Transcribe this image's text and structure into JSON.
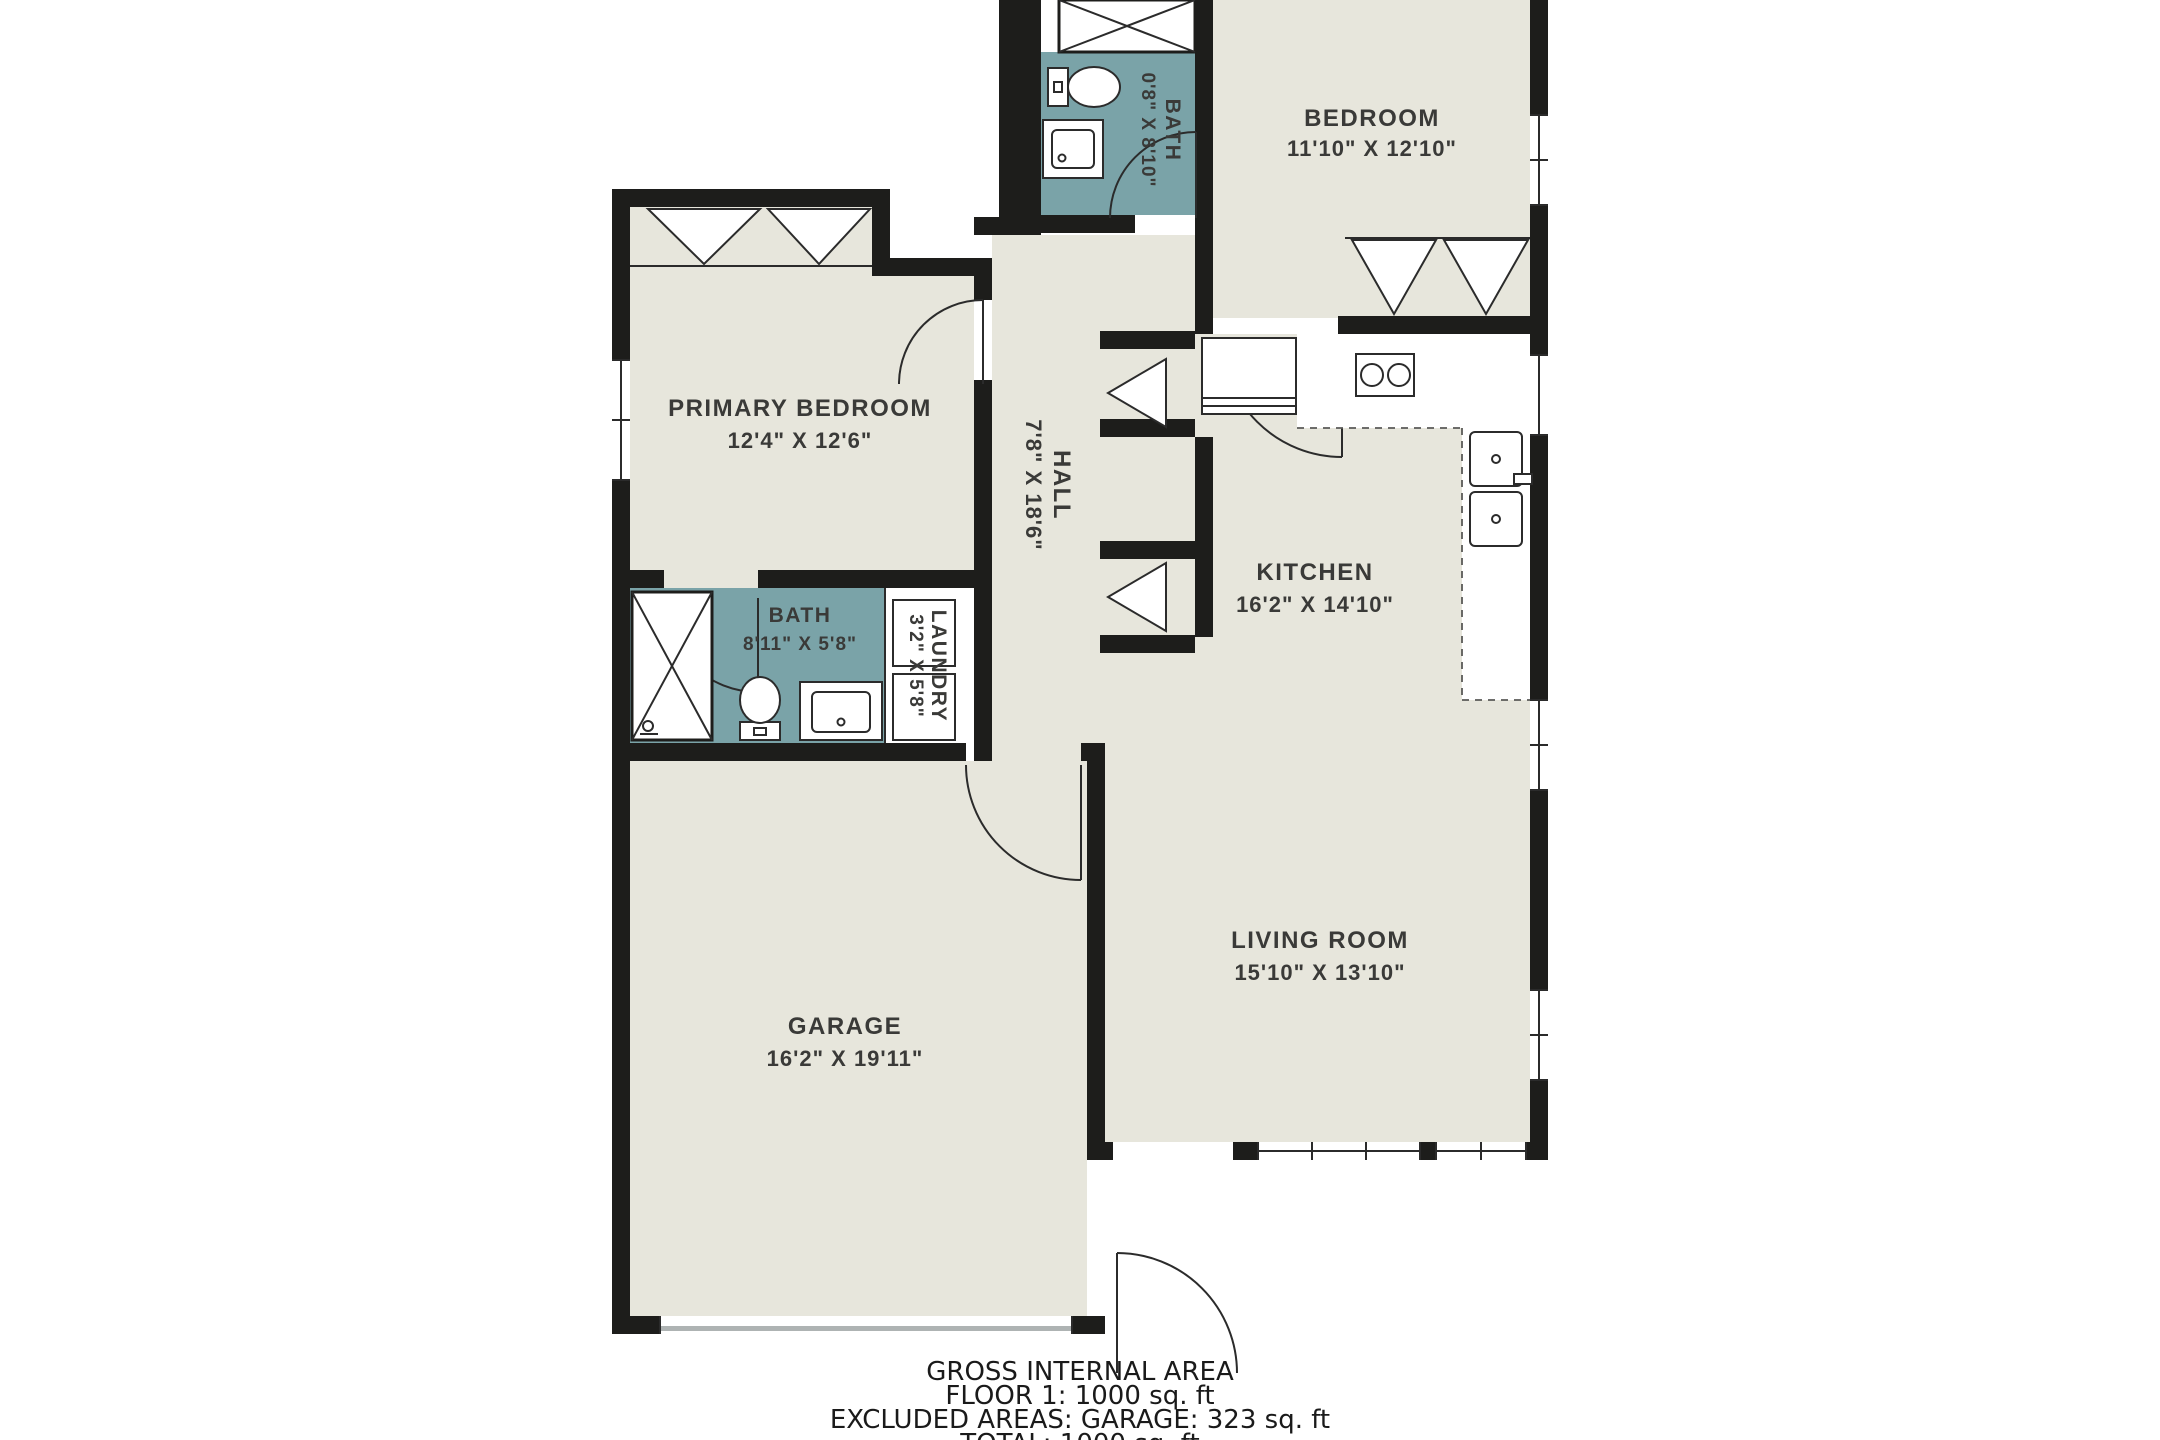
{
  "plan": {
    "type": "floor-plan",
    "rooms": {
      "primary_bedroom": {
        "name": "PRIMARY BEDROOM",
        "dims": "12'4\" X 12'6\""
      },
      "bedroom": {
        "name": "BEDROOM",
        "dims": "11'10\" X 12'10\""
      },
      "bath_upper": {
        "name": "BATH",
        "dims": "0'8\" X 8'10\""
      },
      "bath_main": {
        "name": "BATH",
        "dims": "8'11\" X 5'8\""
      },
      "laundry": {
        "name": "LAUNDRY",
        "dims": "3'2\" X 5'8\""
      },
      "hall": {
        "name": "HALL",
        "dims": "7'8\" X 18'6\""
      },
      "kitchen": {
        "name": "KITCHEN",
        "dims": "16'2\" X 14'10\""
      },
      "living_room": {
        "name": "LIVING ROOM",
        "dims": "15'10\" X 13'10\""
      },
      "garage": {
        "name": "GARAGE",
        "dims": "16'2\" X 19'11\""
      }
    },
    "colors": {
      "background": "#ffffff",
      "room_fill": "#e7e6dc",
      "wet_room_fill": "#7aa3a8",
      "wall": "#1d1d1b",
      "label_text": "#3a3a38"
    }
  },
  "footer": {
    "title": "GROSS INTERNAL AREA",
    "floor": "FLOOR 1: 1000 sq. ft",
    "excluded": "EXCLUDED AREAS: GARAGE: 323 sq. ft",
    "total": "TOTAL: 1000 sq. ft"
  }
}
